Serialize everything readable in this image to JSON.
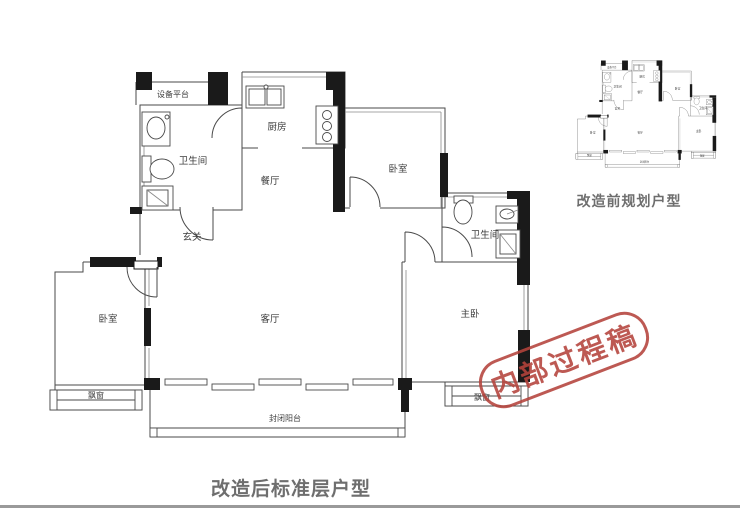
{
  "stamp": {
    "text": "内部过程稿"
  },
  "main_plan": {
    "caption": "改造后标准层户型",
    "rooms": {
      "equipment_platform": "设备平台",
      "bathroom_left": "卫生间",
      "kitchen": "厨房",
      "dining": "餐厅",
      "foyer": "玄关",
      "bedroom_top_right": "卧室",
      "bathroom_right": "卫生间",
      "living_room": "客厅",
      "bedroom_left": "卧室",
      "master_bedroom": "主卧",
      "bay_window_left": "飘窗",
      "bay_window_right": "飘窗",
      "balcony": "封闭阳台"
    }
  },
  "small_plan": {
    "caption": "改造前规划户型"
  },
  "colors": {
    "wall_black": "#1a1a1a",
    "line_gray": "#4a4a4a",
    "stamp_red": "#b5433c",
    "caption_gray": "#6e6e6e"
  }
}
